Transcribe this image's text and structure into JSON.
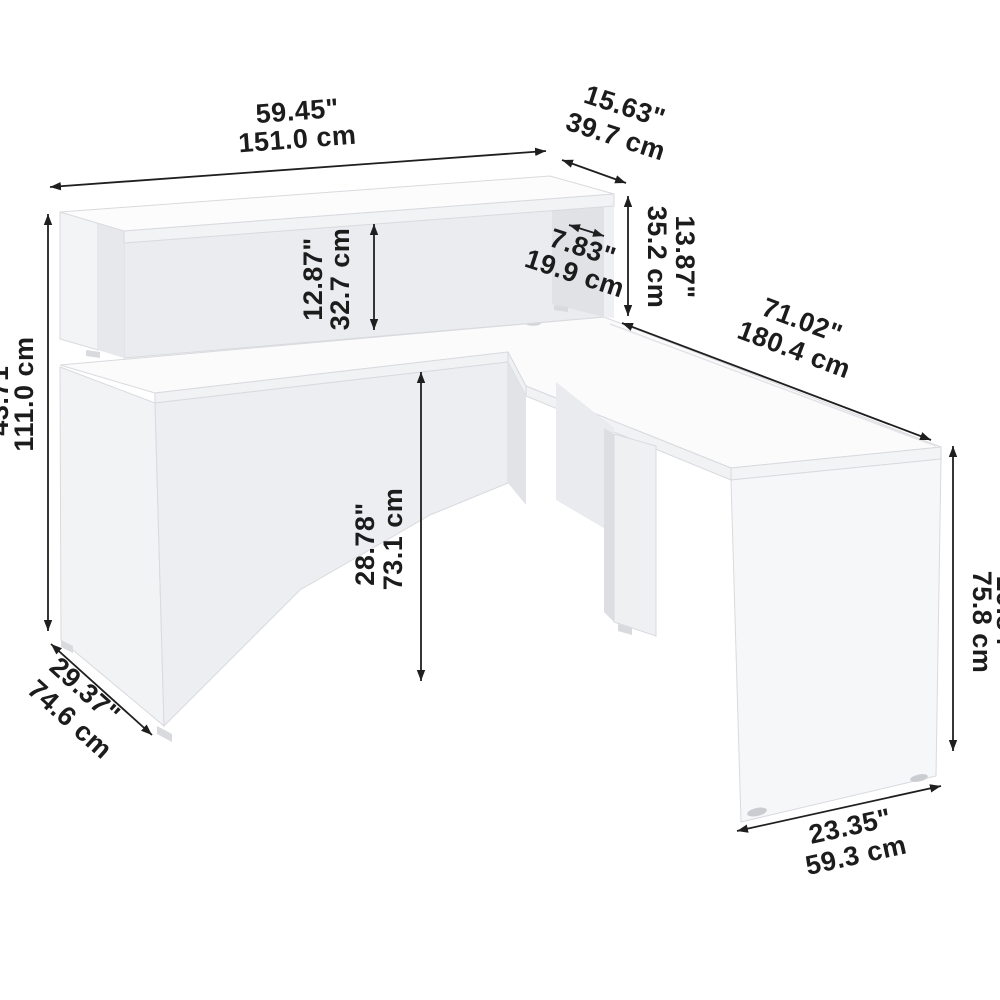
{
  "diagram": {
    "subject": "L-shaped reception desk with hutch - dimension drawing",
    "units": [
      "inches",
      "centimeters"
    ],
    "line_color": "#1f1f1f",
    "furniture_color": "#f0f1f4",
    "dimensions": {
      "hutch_width": {
        "in": "59.45\"",
        "cm": "151.0 cm"
      },
      "hutch_depth": {
        "in": "15.63\"",
        "cm": "39.7 cm"
      },
      "hutch_height": {
        "in": "13.87\"",
        "cm": "35.2 cm"
      },
      "hutch_opening_depth": {
        "in": "7.83\"",
        "cm": "19.9 cm"
      },
      "hutch_opening_height": {
        "in": "12.87\"",
        "cm": "32.7 cm"
      },
      "overall_height": {
        "in": "43.71\"",
        "cm": "111.0 cm"
      },
      "worksurface_height": {
        "in": "28.78\"",
        "cm": "73.1 cm"
      },
      "overall_depth": {
        "in": "71.02\"",
        "cm": "180.4 cm"
      },
      "desk_depth": {
        "in": "29.37\"",
        "cm": "74.6 cm"
      },
      "return_width": {
        "in": "23.35\"",
        "cm": "59.3 cm"
      },
      "return_panel_height": {
        "in": "29.84\"",
        "cm": "75.8 cm"
      }
    }
  }
}
